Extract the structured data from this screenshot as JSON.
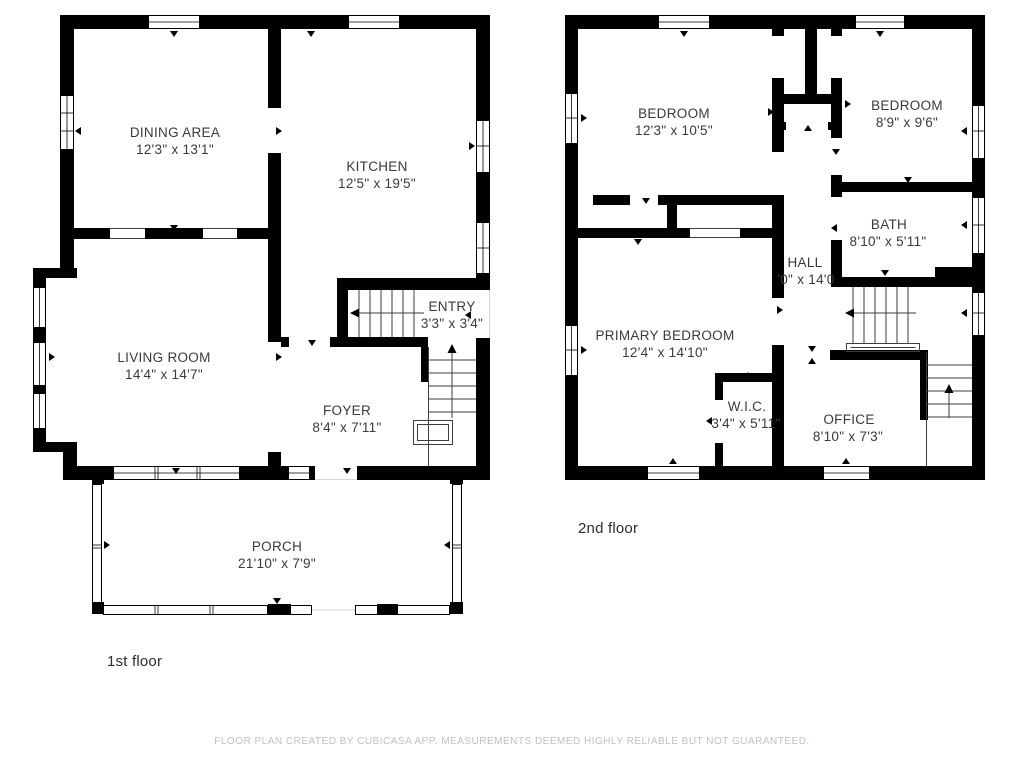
{
  "floors": [
    {
      "label": "1st floor",
      "rooms": [
        {
          "name": "DINING AREA",
          "dims": "12'3\" x 13'1\""
        },
        {
          "name": "KITCHEN",
          "dims": "12'5\" x 19'5\""
        },
        {
          "name": "ENTRY",
          "dims": "3'3\" x 3'4\""
        },
        {
          "name": "LIVING ROOM",
          "dims": "14'4\" x 14'7\""
        },
        {
          "name": "FOYER",
          "dims": "8'4\" x 7'11\""
        },
        {
          "name": "PORCH",
          "dims": "21'10\" x 7'9\""
        }
      ]
    },
    {
      "label": "2nd floor",
      "rooms": [
        {
          "name": "BEDROOM",
          "dims": "12'3\" x 10'5\""
        },
        {
          "name": "BEDROOM",
          "dims": "8'9\" x 9'6\""
        },
        {
          "name": "BATH",
          "dims": "8'10\" x 5'11\""
        },
        {
          "name": "HALL",
          "dims": "'0\" x 14'0"
        },
        {
          "name": "PRIMARY BEDROOM",
          "dims": "12'4\" x 14'10\""
        },
        {
          "name": "W.I.C.",
          "dims": "3'4\" x 5'11\""
        },
        {
          "name": "OFFICE",
          "dims": "8'10\" x 7'3\""
        }
      ]
    }
  ],
  "footer": {
    "disclaimer": "FLOOR PLAN CREATED BY CUBICASA APP. MEASUREMENTS DEEMED HIGHLY RELIABLE BUT NOT GUARANTEED."
  },
  "colors": {
    "wall": "#000000",
    "background": "#ffffff",
    "room_label_text": "#3a3a3a",
    "floor_label_text": "#2d2d2d",
    "footer_text": "#c1c1c1",
    "stair_line": "#3e3e3e"
  }
}
